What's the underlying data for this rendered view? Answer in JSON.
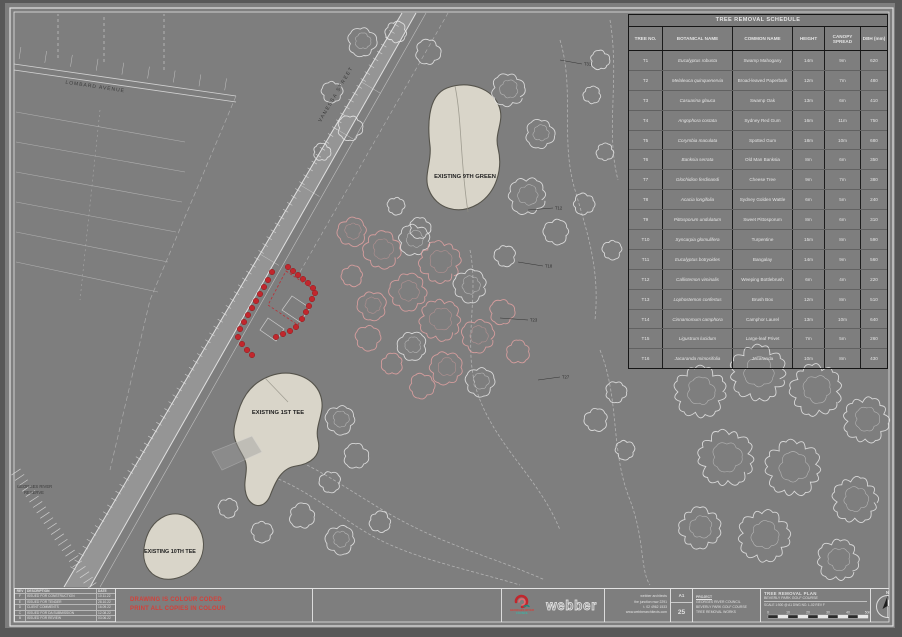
{
  "plan": {
    "green_9_label": "EXISTING 9TH GREEN",
    "tee_1_label": "EXISTING 1ST TEE",
    "tee_10_label": "EXISTING 10TH TEE",
    "street_top_label": "LOMBARD AVENUE",
    "street_diagonal_label": "VANESSA STREET",
    "reserve_label_line1": "GEORGES RIVER",
    "reserve_label_line2": "RESERVE",
    "tree_tags": [
      "T12",
      "T18",
      "T23",
      "T27",
      "T31"
    ]
  },
  "schedule": {
    "title": "TREE REMOVAL SCHEDULE",
    "headers": [
      "TREE NO.",
      "BOTANICAL NAME",
      "COMMON NAME",
      "HEIGHT",
      "CANOPY SPREAD",
      "DBH (mm)"
    ],
    "rows": [
      [
        "T1",
        "Eucalyptus robusta",
        "Swamp Mahogany",
        "14m",
        "9m",
        "620"
      ],
      [
        "T2",
        "Melaleuca quinquenervia",
        "Broad-leaved Paperbark",
        "12m",
        "7m",
        "480"
      ],
      [
        "T3",
        "Casuarina glauca",
        "Swamp Oak",
        "13m",
        "6m",
        "410"
      ],
      [
        "T4",
        "Angophora costata",
        "Sydney Red Gum",
        "16m",
        "11m",
        "750"
      ],
      [
        "T5",
        "Corymbia maculata",
        "Spotted Gum",
        "18m",
        "10m",
        "680"
      ],
      [
        "T6",
        "Banksia serrata",
        "Old Man Banksia",
        "8m",
        "6m",
        "350"
      ],
      [
        "T7",
        "Glochidion ferdinandi",
        "Cheese Tree",
        "9m",
        "7m",
        "380"
      ],
      [
        "T8",
        "Acacia longifolia",
        "Sydney Golden Wattle",
        "6m",
        "5m",
        "240"
      ],
      [
        "T9",
        "Pittosporum undulatum",
        "Sweet Pittosporum",
        "8m",
        "6m",
        "310"
      ],
      [
        "T10",
        "Syncarpia glomulifera",
        "Turpentine",
        "15m",
        "8m",
        "590"
      ],
      [
        "T11",
        "Eucalyptus botryoides",
        "Bangalay",
        "14m",
        "9m",
        "560"
      ],
      [
        "T12",
        "Callistemon viminalis",
        "Weeping Bottlebrush",
        "6m",
        "4m",
        "220"
      ],
      [
        "T13",
        "Lophostemon confertus",
        "Brush Box",
        "12m",
        "8m",
        "510"
      ],
      [
        "T14",
        "Cinnamomum camphora",
        "Camphor Laurel",
        "13m",
        "10m",
        "640"
      ],
      [
        "T15",
        "Ligustrum lucidum",
        "Large-leaf Privet",
        "7m",
        "5m",
        "260"
      ],
      [
        "T16",
        "Jacaranda mimosifolia",
        "Jacaranda",
        "10m",
        "8m",
        "430"
      ]
    ]
  },
  "titleblock": {
    "revisions": {
      "headers": [
        "REV",
        "DESCRIPTION",
        "DATE"
      ],
      "rows": [
        [
          "F",
          "ISSUED FOR CONSTRUCTION",
          "10.11.22"
        ],
        [
          "E",
          "ISSUED FOR TENDER",
          "28.10.22"
        ],
        [
          "D",
          "CLIENT COMMENTS",
          "16.09.22"
        ],
        [
          "C",
          "ISSUED FOR DA SUBMISSION",
          "12.08.22"
        ],
        [
          "B",
          "ISSUED FOR REVIEW",
          "03.06.22"
        ],
        [
          "A",
          "PRELIMINARY ISSUE",
          "21.04.22"
        ]
      ]
    },
    "warning_line1": "DRAWING IS COLOUR CODED",
    "warning_line2": "PRINT ALL COPIES IN COLOUR",
    "council_line1": "GEORGES RIVER",
    "council_line2": "COUNCIL",
    "firm": "webber",
    "contact_lines": [
      "webber architects",
      "the junction nsw 2291",
      "t. 02 4962 1533",
      "www.webberarchitects.com"
    ],
    "sheet_size": "A1",
    "sheet_no": "25",
    "project_lines": [
      "PROJECT",
      "GEORGES RIVER COUNCIL",
      "BEVERLY PARK GOLF COURSE",
      "TREE REMOVAL WORKS"
    ],
    "drawing_title": "TREE REMOVAL PLAN",
    "drawing_sub": "BEVERLY PARK GOLF COURSE",
    "drawing_meta": "SCALE 1:500 @ A1   DWG NO. L-02   REV F",
    "scale_labels": [
      "0",
      "10",
      "20",
      "30",
      "40",
      "50m"
    ],
    "north_label": "N"
  },
  "colors": {
    "removal_red": "#c1272d",
    "surface_beige": "#d9d5c9",
    "warning_red": "#d4403a",
    "council_red": "#c1272d",
    "council_teal": "#1b8a7d",
    "linework": "#e3e3e3"
  }
}
